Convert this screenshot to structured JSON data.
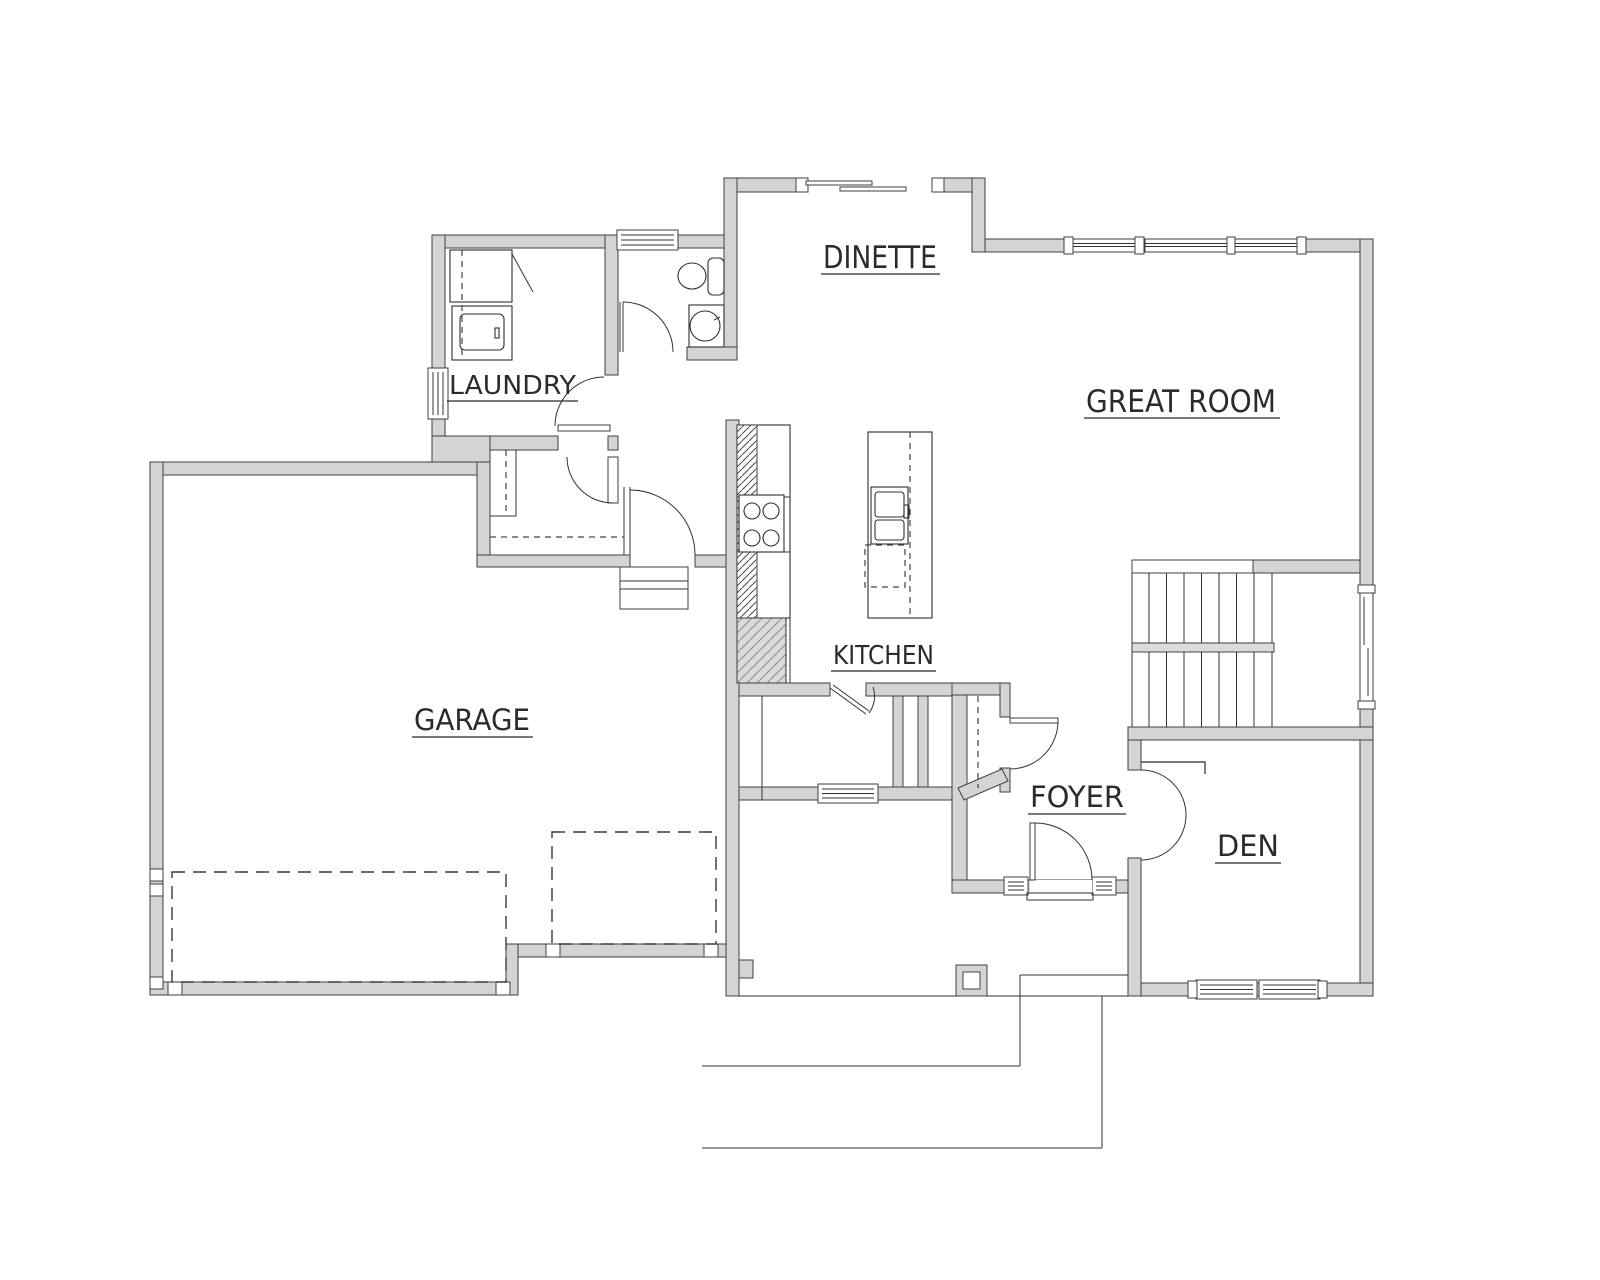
{
  "drawing": {
    "type": "floor-plan",
    "view": "main-level"
  },
  "colors": {
    "background": "#ffffff",
    "wall_fill": "#d4d4d4",
    "wall_outline": "#3f3f3f",
    "detail_line": "#333333",
    "label_text": "#2b2b2b"
  },
  "rooms": [
    {
      "id": "dinette",
      "label": "DINETTE"
    },
    {
      "id": "great_room",
      "label": "GREAT ROOM"
    },
    {
      "id": "laundry",
      "label": "LAUNDRY"
    },
    {
      "id": "kitchen",
      "label": "KITCHEN"
    },
    {
      "id": "garage",
      "label": "GARAGE"
    },
    {
      "id": "foyer",
      "label": "FOYER"
    },
    {
      "id": "den",
      "label": "DEN"
    }
  ],
  "features": {
    "sliding_door": "sliding-door-icon",
    "window": "window-icon",
    "door_swing": "door-swing-icon",
    "stairs": "stairs-icon",
    "cooktop": "cooktop-icon",
    "island_sink": "sink-icon",
    "dishwasher": "dishwasher-icon",
    "washer": "washer-icon",
    "toilet": "toilet-icon",
    "pedestal_sink": "sink-icon",
    "garage_door": "garage-door-icon",
    "porch_post": "porch-post-icon",
    "entry_step": "entry-step-icon",
    "closet_rod": "closet-rod-icon"
  }
}
